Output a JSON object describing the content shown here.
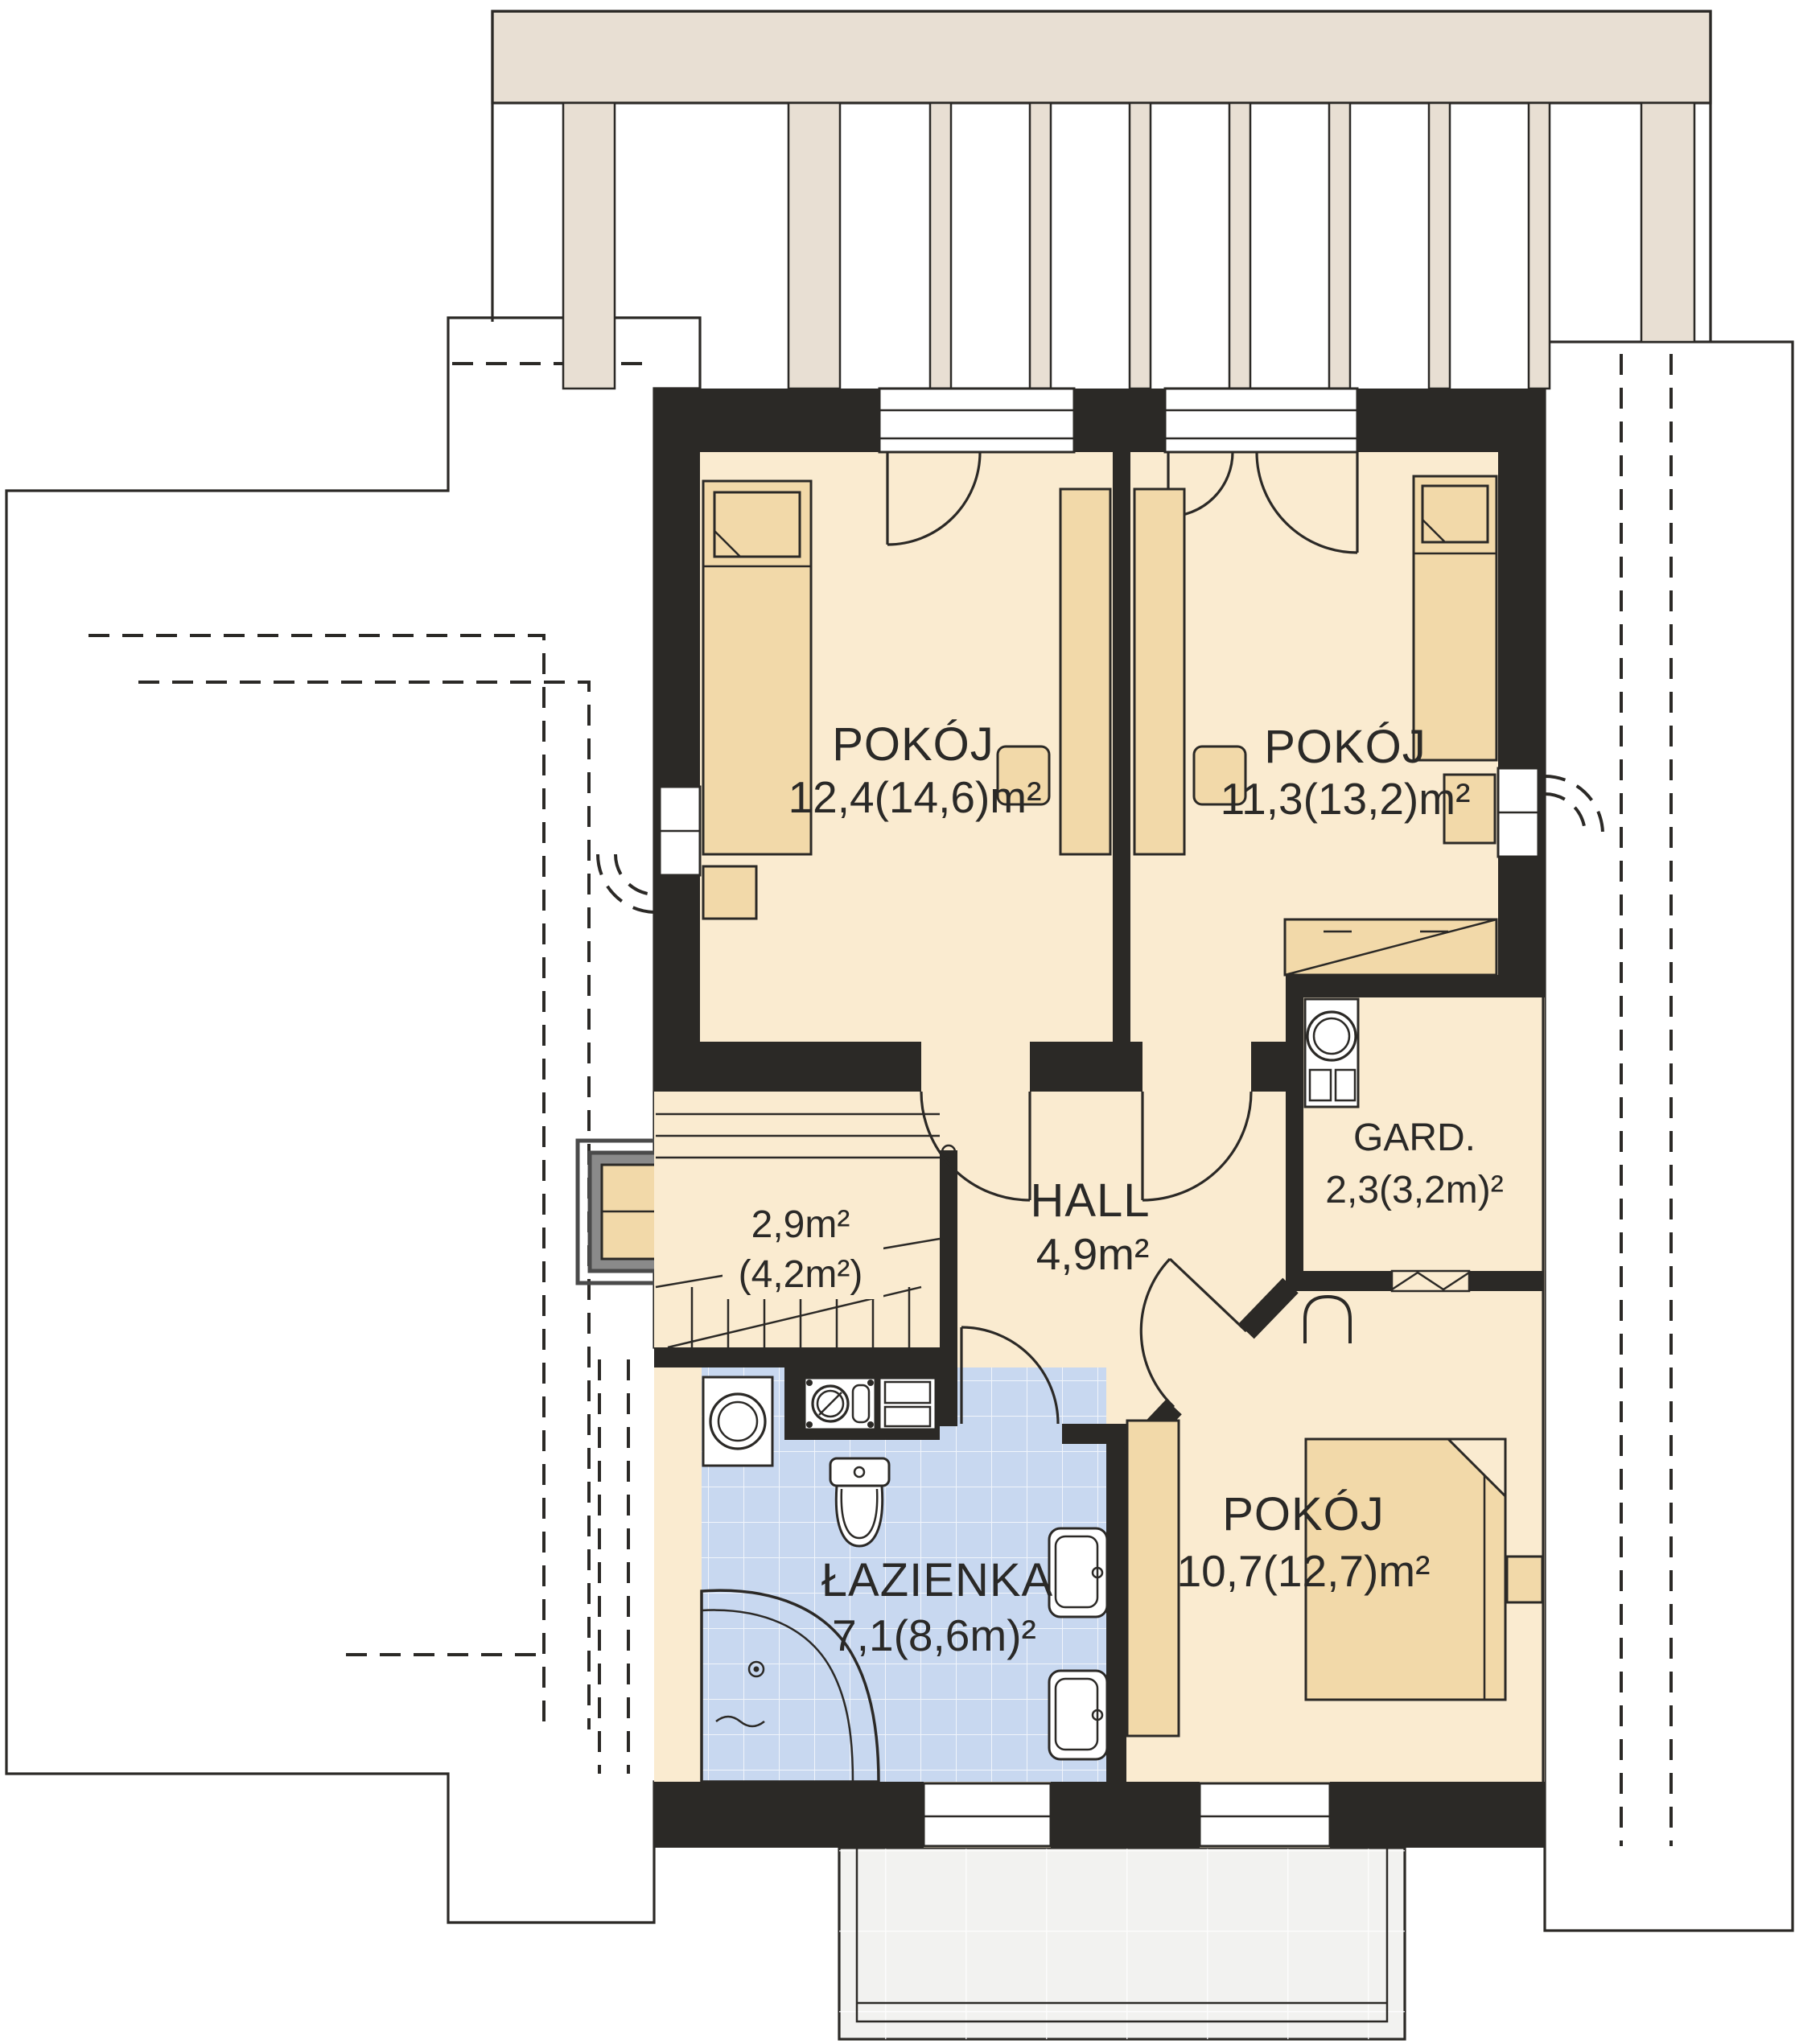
{
  "title": "attic floor plan",
  "rooms": {
    "room1": {
      "name": "POKÓJ",
      "area": "12,4(14,6)m²"
    },
    "room2": {
      "name": "POKÓJ",
      "area": "11,3(13,2)m²"
    },
    "room3": {
      "name": "POKÓJ",
      "area": "10,7(12,7)m²"
    },
    "bathroom": {
      "name": "ŁAZIENKA",
      "area": "7,1(8,6m)²"
    },
    "hall": {
      "name": "HALL",
      "area": "4,9m²"
    },
    "wardrobe": {
      "name": "GARD.",
      "area": "2,3(3,2m)²"
    },
    "stairs": {
      "area": "2,9m²",
      "area_secondary": "(4,2m²)"
    }
  },
  "colors": {
    "wall": "#2b2926",
    "line": "#2b2926",
    "roof": "#8a8a8a",
    "roofline": "#3e3e3e",
    "floor": "#faebd0",
    "furn": "#f2d9a9",
    "bath": "#c8d8f0",
    "balcony": "#e8dfd3",
    "terrace": "#f2f2f0"
  }
}
